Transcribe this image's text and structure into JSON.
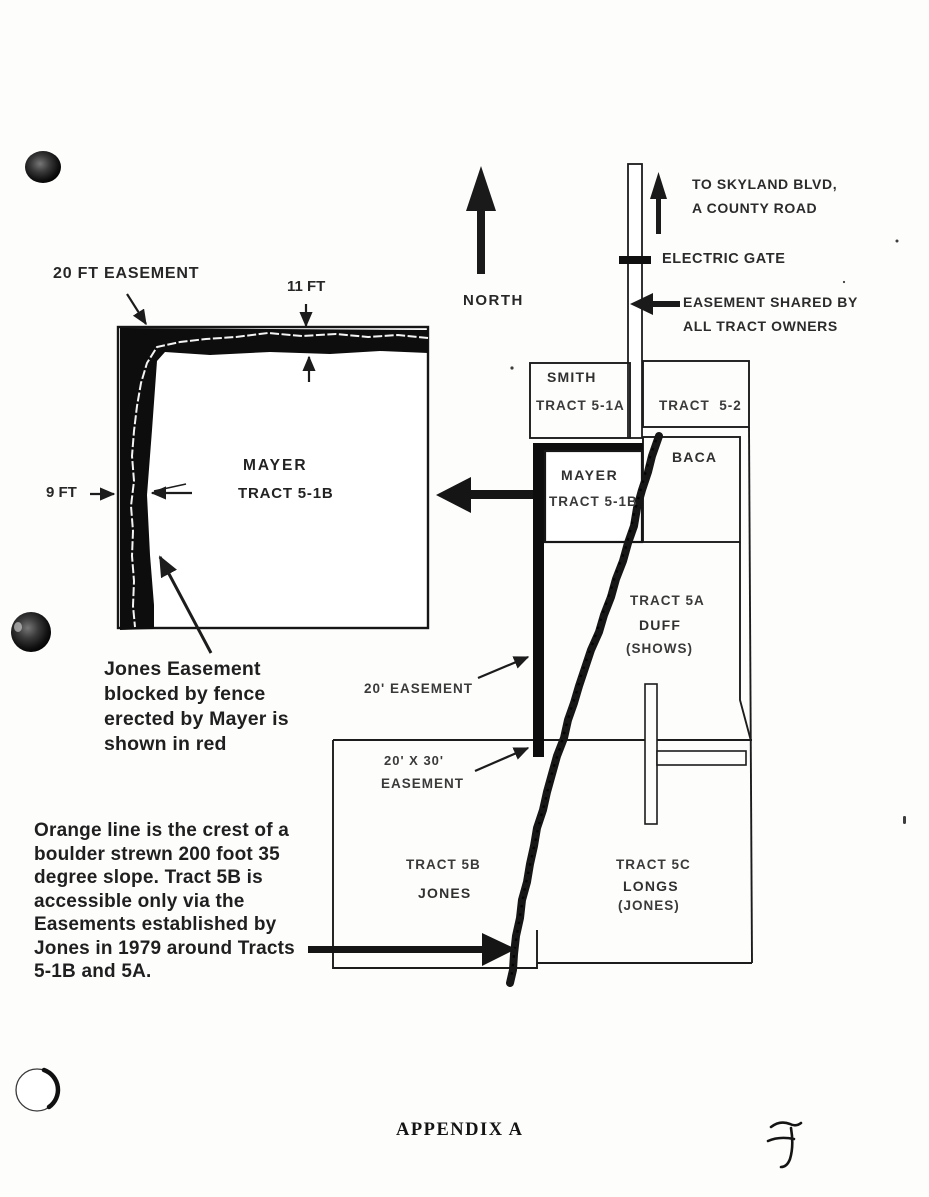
{
  "doc": {
    "appendix": "APPENDIX A",
    "handwritten_mark": "F"
  },
  "compass": {
    "north": "NORTH"
  },
  "road": {
    "destination": [
      "TO SKYLAND BLVD,",
      "A COUNTY ROAD"
    ],
    "gate": "ELECTRIC GATE",
    "shared_easement": [
      "EASEMENT SHARED BY",
      "ALL TRACT OWNERS"
    ]
  },
  "inset": {
    "top_easement": "20 FT EASEMENT",
    "top_width": "11 FT",
    "side_width": "9 FT",
    "owner": "MAYER",
    "tract": "TRACT 5-1B",
    "note": [
      "Jones Easement",
      "blocked by fence",
      "erected by Mayer is",
      "shown in red"
    ]
  },
  "map": {
    "smith": {
      "owner": "SMITH",
      "tract": "TRACT 5-1A"
    },
    "tract_5_2": {
      "tract": "TRACT  5-2"
    },
    "mayer": {
      "owner": "MAYER",
      "tract": "TRACT 5-1B"
    },
    "baca": {
      "owner": "BACA"
    },
    "duff": {
      "tract": "TRACT 5A",
      "owner": "DUFF",
      "note": "(SHOWS)"
    },
    "tract_5b": {
      "tract": "TRACT 5B",
      "owner": "JONES"
    },
    "tract_5c": {
      "tract": "TRACT 5C",
      "owner": "LONGS",
      "note": "(JONES)"
    },
    "easement_20": "20' EASEMENT",
    "easement_20x30": [
      "20' X 30'",
      "EASEMENT"
    ]
  },
  "slope_note": [
    "Orange line is the crest of a",
    "boulder strewn 200 foot 35",
    "degree slope. Tract 5B is",
    "accessible only via the",
    "Easements established by",
    "Jones in 1979 around Tracts",
    "5-1B and 5A."
  ],
  "colors": {
    "ink": "#1c1c1c",
    "paper": "#fdfdfc"
  }
}
